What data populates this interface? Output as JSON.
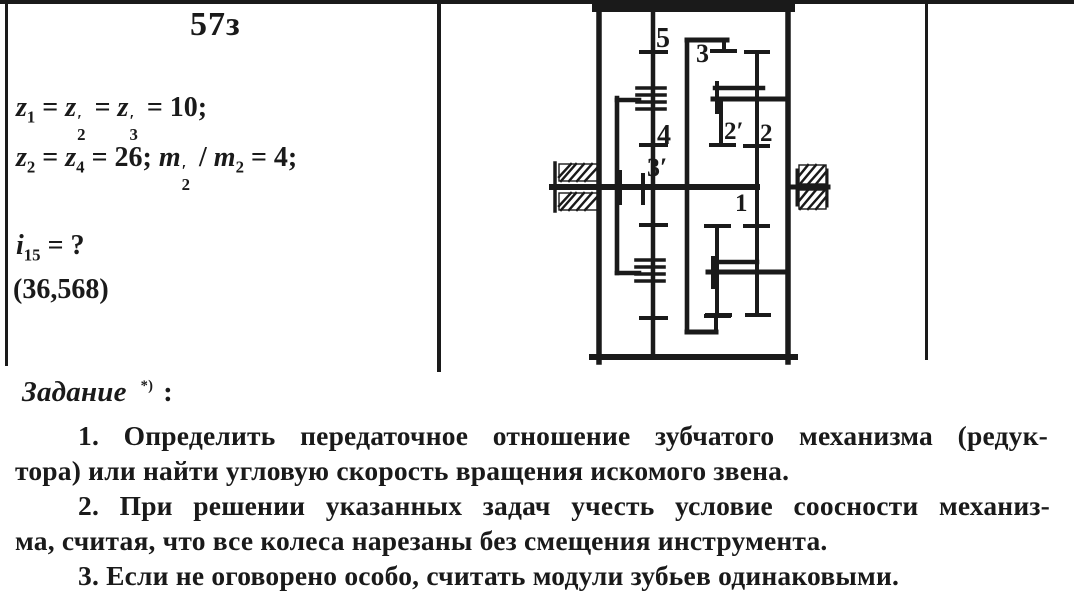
{
  "colors": {
    "ink": "#1a1a1a",
    "paper": "#ffffff"
  },
  "problem": {
    "number": "57з"
  },
  "given": {
    "line1": {
      "tokens": [
        {
          "v": "z"
        },
        {
          "s": "1"
        },
        {
          "t": " = "
        },
        {
          "v": "z"
        },
        {
          "ps": "2"
        },
        {
          "t": " = "
        },
        {
          "v": "z"
        },
        {
          "ps": "3"
        },
        {
          "t": " = 10;"
        }
      ]
    },
    "line2": {
      "tokens": [
        {
          "v": "z"
        },
        {
          "s": "2"
        },
        {
          "t": " = "
        },
        {
          "v": "z"
        },
        {
          "s": "4"
        },
        {
          "t": " = 26; "
        },
        {
          "v": "m"
        },
        {
          "ps": "2"
        },
        {
          "t": " / "
        },
        {
          "v": "m"
        },
        {
          "s": "2"
        },
        {
          "t": " = 4;"
        }
      ]
    },
    "line3": {
      "tokens": [
        {
          "v": "i"
        },
        {
          "s": "15"
        },
        {
          "t": " = ?"
        }
      ]
    },
    "answer": "(36,568)"
  },
  "diagram": {
    "labels": {
      "g5": "5",
      "g4": "4",
      "g3p": "3′",
      "g3": "3",
      "g2p": "2′",
      "g2": "2",
      "g1": "1"
    }
  },
  "task": {
    "heading": "Задание",
    "heading_mark": "*)",
    "heading_colon": ":",
    "lines": [
      "1. Определить передаточное отношение зубчатого механизма (редук-",
      "тора) или найти угловую скорость вращения искомого звена.",
      "2. При решении указанных задач учесть условие соосности механиз-",
      "ма, считая, что все колеса нарезаны без смещения инструмента.",
      "3. Если не оговорено особо, считать модули зубьев одинаковыми."
    ]
  }
}
